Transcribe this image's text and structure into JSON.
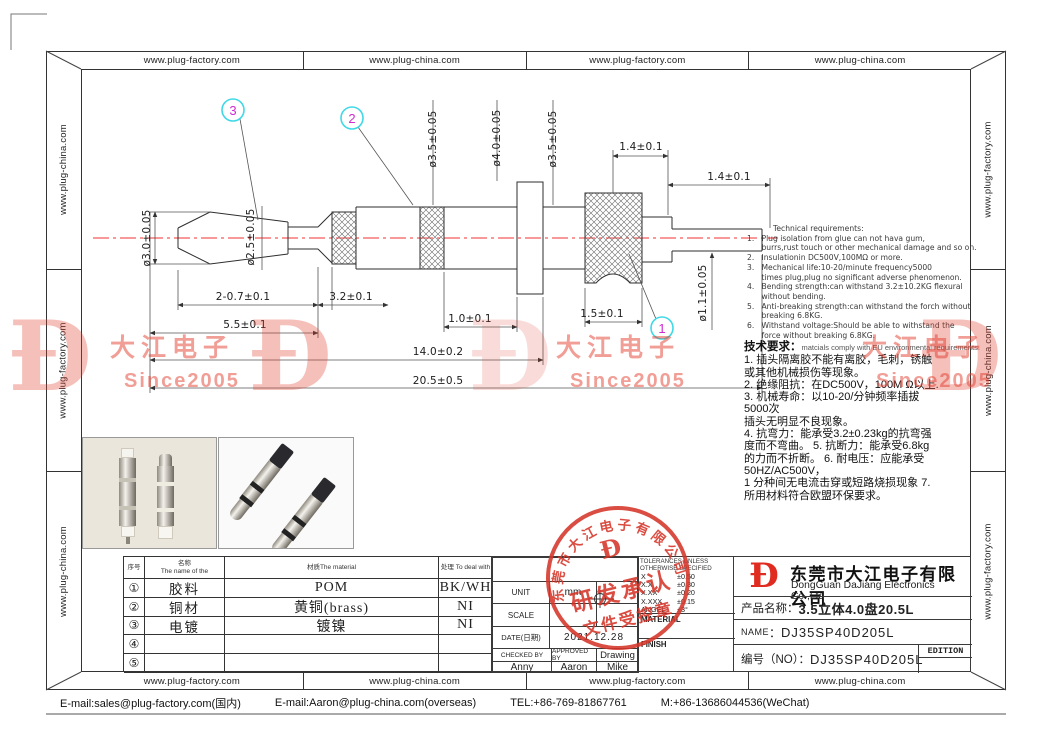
{
  "frame": {
    "top_cells": [
      "www.plug-factory.com",
      "www.plug-china.com",
      "www.plug-factory.com",
      "www.plug-china.com"
    ],
    "bottom_cells": [
      "www.plug-factory.com",
      "www.plug-china.com",
      "www.plug-factory.com",
      "www.plug-china.com"
    ],
    "left_cells": [
      "www.plug-china.com",
      "www.plug-factory.com",
      "www.plug-china.com"
    ],
    "right_cells": [
      "www.plug-factory.com",
      "www.plug-china.com",
      "www.plug-factory.com"
    ]
  },
  "footer": {
    "email_domestic": "E-mail:sales@plug-factory.com(国内)",
    "email_overseas": "E-mail:Aaron@plug-china.com(overseas)",
    "tel": "TEL:+86-769-81867761",
    "mobile": "M:+86-13686044536(WeChat)"
  },
  "drawing": {
    "balloons": {
      "one": "1",
      "two": "2",
      "three": "3"
    },
    "dims": {
      "tip_dia": "ø3.0±0.05",
      "neck_dia": "ø2.5±0.05",
      "dia_35a": "ø3.5±0.05",
      "dia_40": "ø4.0±0.05",
      "dia_35b": "ø3.5±0.05",
      "len_14a": "1.4±0.1",
      "len_14b": "1.4±0.1",
      "len_207": "2-0.7±0.1",
      "len_32": "3.2±0.1",
      "len_55": "5.5±0.1",
      "len_10": "1.0±0.1",
      "len_15": "1.5±0.1",
      "len_140": "14.0±0.2",
      "len_205": "20.5±0.5",
      "pin_dia": "ø1.1±0.05"
    }
  },
  "tech_req_en": {
    "title": "Technical requirements:",
    "lines": [
      "1.   Plug isolation from glue can not hava gum,",
      "      burrs,rust touch or other mechanical damage and so on.",
      "2.   Insulationin DC500V,100MΩ or more.",
      "3.   Mechanical life:10-20/minute frequency5000",
      "      times plug,plug no significant adverse phenomenon.",
      "4.   Bending strength:can withstand 3.2±10.2KG flexural",
      "      without bending.",
      "5.   Anti-breaking strength:can withstand the forch without",
      "      breaking 6.8KG.",
      "6.   Withstand voltage:Should be able to withstand the",
      "      force without breaking 6.8KG."
    ]
  },
  "tech_req_cn": {
    "title": "技术要求：",
    "title_suffix": "matcials comply with EU environmental requirements.",
    "lines": [
      "1. 插头隔离胶不能有离胶，毛刺，锈触",
      "或其他机械损伤等现象。",
      "2. 绝缘阻抗：在DC500V，100M Ω以上.",
      "3. 机械寿命：以10-20/分钟频率插拔",
      "5000次",
      "插头无明显不良现象。",
      "4. 抗弯力：能承受3.2±0.23kg的抗弯强",
      "度而不弯曲。 5. 抗断力：能承受6.8kg",
      "的力而不折断。 6. 耐电压：应能承受",
      "50HZ/AC500V，",
      "1 分种间无电流击穿或短路烧损现象 7.",
      "所用材料符合欧盟环保要求。"
    ]
  },
  "parts_table": {
    "headers": {
      "no": "序号",
      "name1": "名称",
      "name2": "The name of the",
      "material": "材质The material",
      "treat": "处理 To deal with"
    },
    "rows": [
      {
        "no": "①",
        "name": "胶料",
        "material": "POM",
        "treat": "BK/WH"
      },
      {
        "no": "②",
        "name": "铜材",
        "material": "黄铜(brass)",
        "treat": "NI"
      },
      {
        "no": "③",
        "name": "电镀",
        "material": "镀镍",
        "treat": "NI"
      },
      {
        "no": "④",
        "name": "",
        "material": "",
        "treat": ""
      },
      {
        "no": "⑤",
        "name": "",
        "material": "",
        "treat": ""
      }
    ]
  },
  "info_block": {
    "unit_label": "UNIT",
    "unit_value": "mm",
    "scale_label": "SCALE",
    "date_label": "DATE(日期)",
    "date_value": "2021.12.28",
    "checked_label": "CHECKED BY",
    "approved_label": "APPROVED BY",
    "drawing_label": "Drawing",
    "checked_by": "Anny",
    "approved_by": "Aaron",
    "drawn_by": "Mike"
  },
  "tolerance_block": {
    "title1": "TOLERANCES UNLESS",
    "title2": "OTHERWISE SPECIFIED",
    "rows": [
      {
        "k": "X",
        "v": "±0.50"
      },
      {
        "k": "X.X",
        "v": "±0.30"
      },
      {
        "k": "X.XX",
        "v": "±0.20"
      },
      {
        "k": "X.XXX",
        "v": "±0.15"
      },
      {
        "k": "ANGEL",
        "v": "±3°"
      }
    ],
    "material_label": "MATERIAL",
    "finish_label": "FINISH"
  },
  "title_block": {
    "logo_char": "Đ",
    "company_cn": "东莞市大江电子有限公司",
    "company_en": "DongGuan DaJiang Electronics Co.,Ltd",
    "product_label": "产品名称：",
    "product_value": "3.5立体4.0盘20.5L",
    "name_label": "NAME",
    "name_sep": "：",
    "name_value": "DJ35SP40D205L",
    "no_label": "编号（NO）：",
    "no_value": "DJ35SP40D205L",
    "edition_label": "EDITION"
  },
  "stamp": {
    "arc_text": "东莞市大江电子有限公司",
    "logo_char": "Đ",
    "line1": "研发承认",
    "line2": "文件受控章"
  },
  "watermark": {
    "logo_char": "Đ",
    "text1": "大江电子",
    "text2": "Since2005"
  },
  "colors": {
    "centerline": "#f03030",
    "balloon_ring": "#3fd8e6",
    "balloon_number": "#d02bd0",
    "stamp_red": "#d63529",
    "watermark_red": "#e23e2e"
  }
}
